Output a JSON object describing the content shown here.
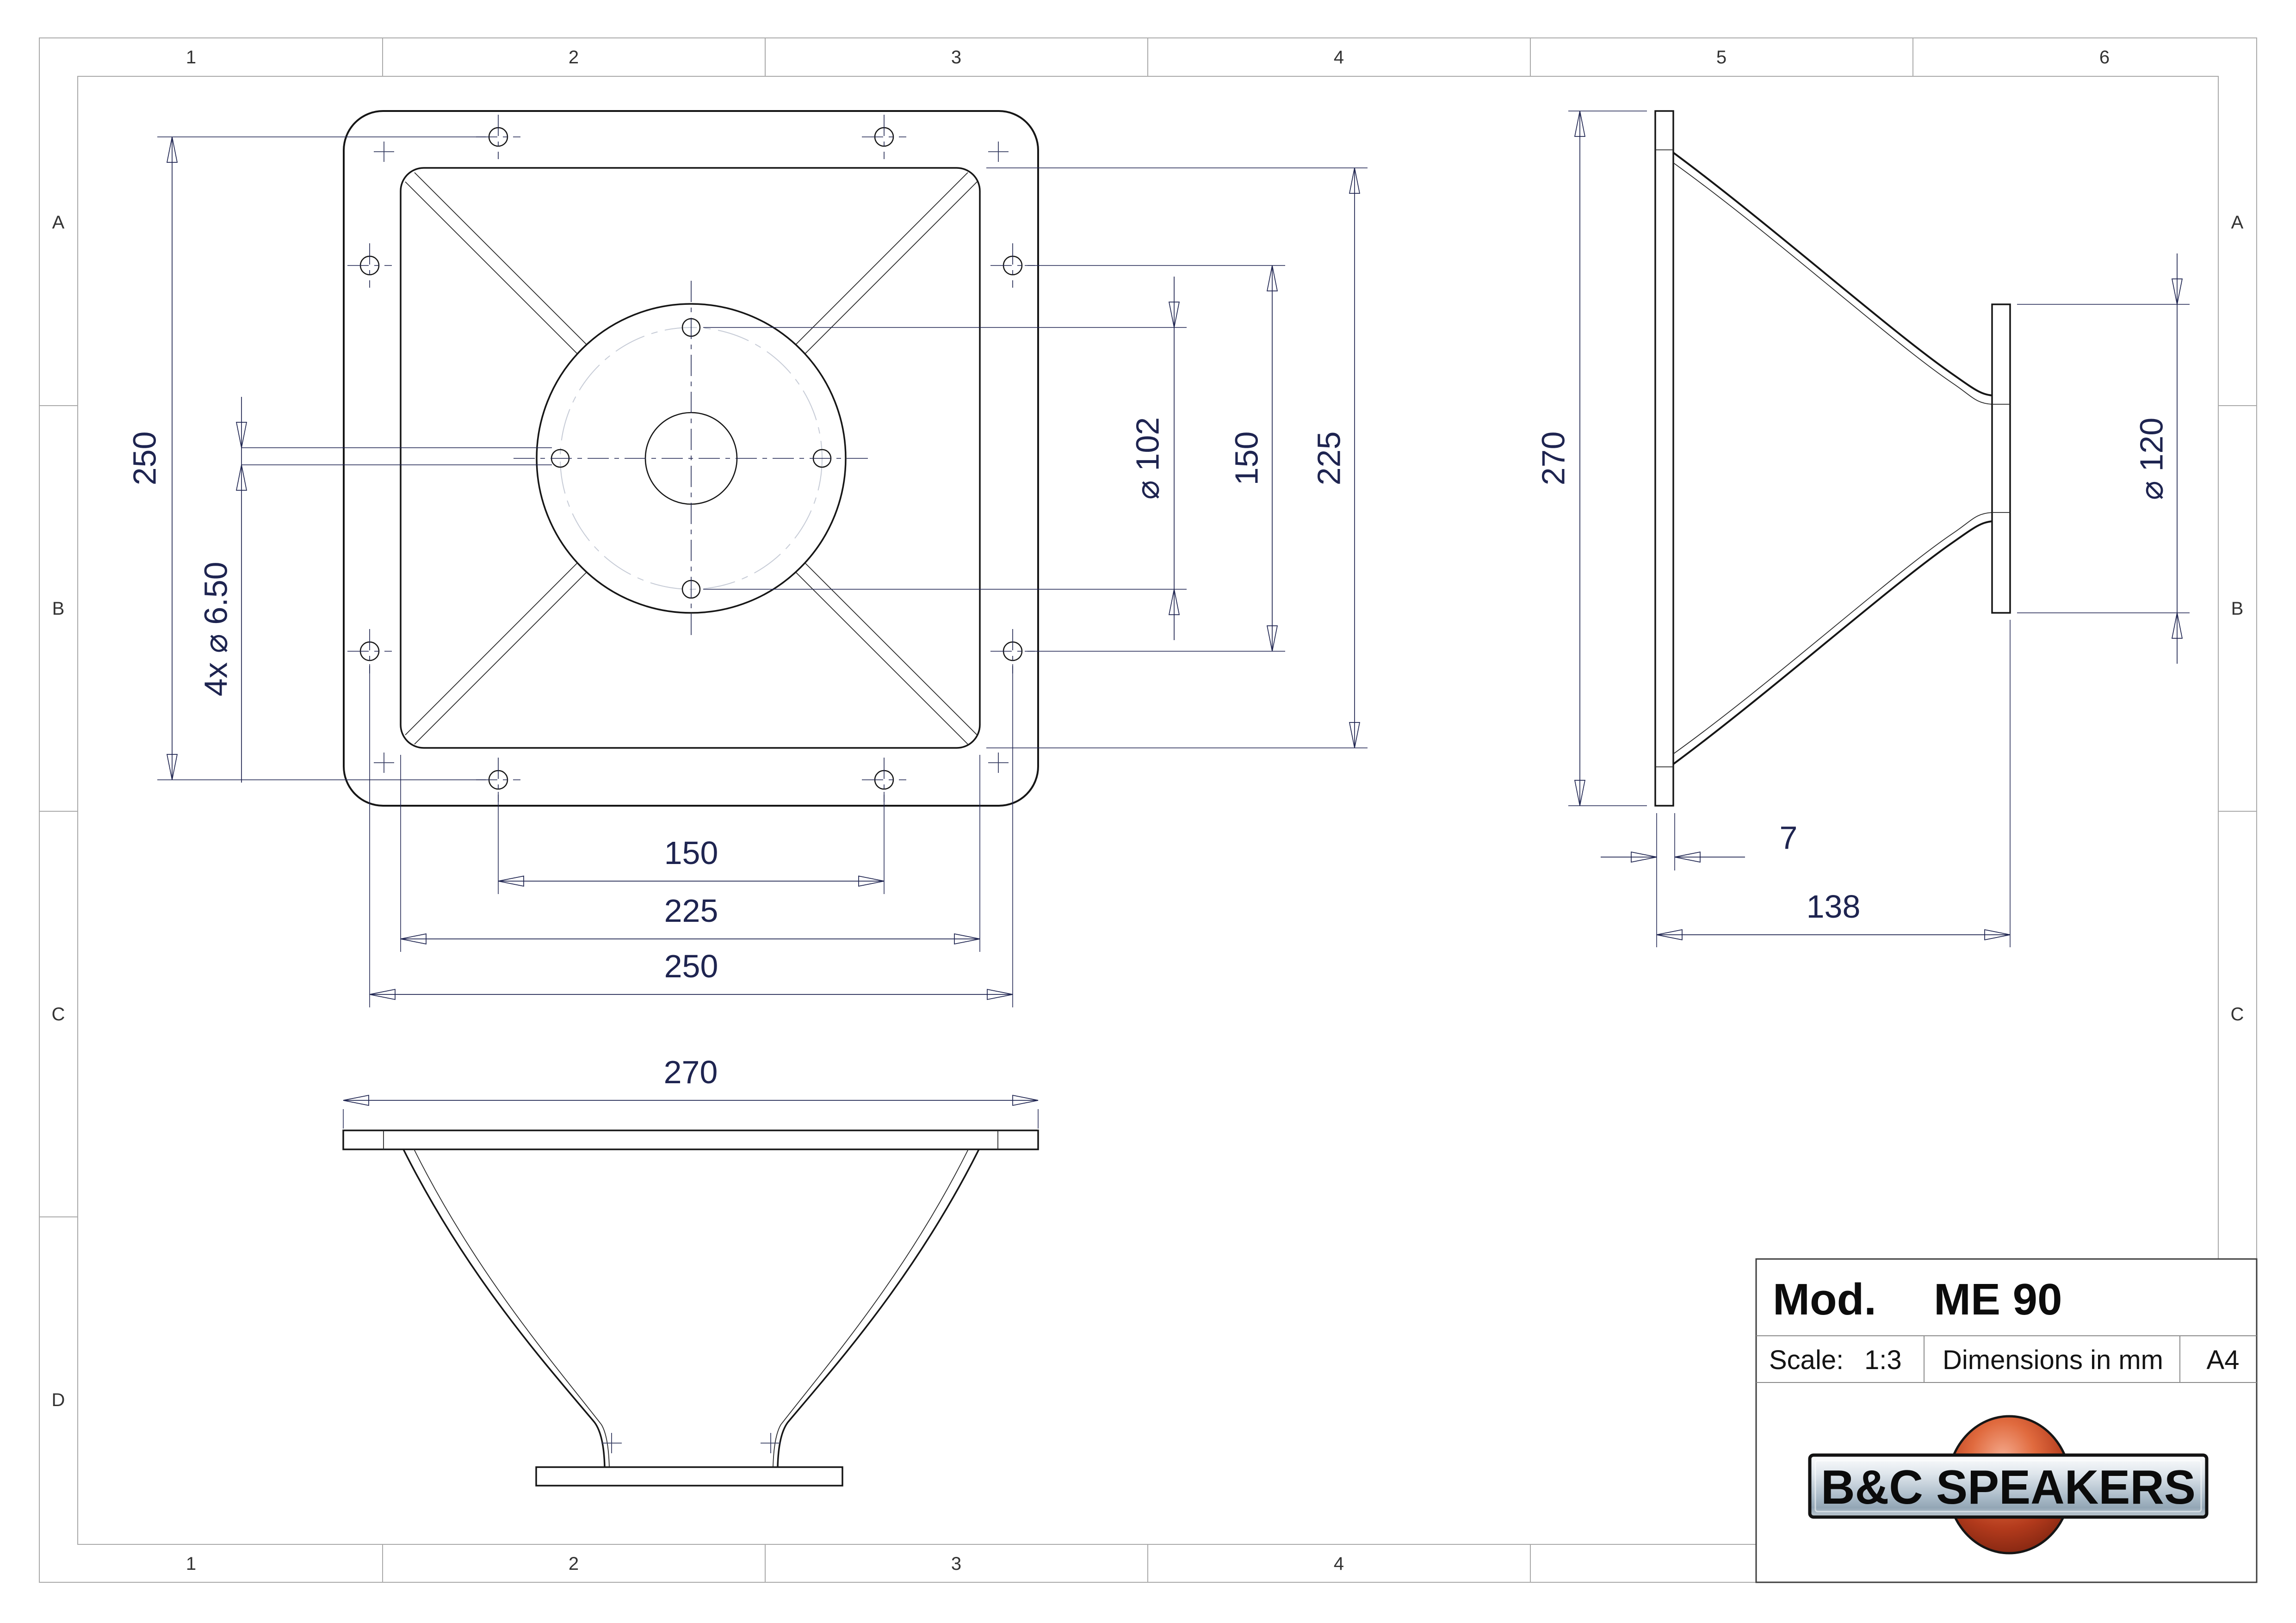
{
  "grid": {
    "top": [
      "1",
      "2",
      "3",
      "4",
      "5",
      "6"
    ],
    "bottom": [
      "1",
      "2",
      "3",
      "4"
    ],
    "left": [
      "A",
      "B",
      "C",
      "D"
    ],
    "right": [
      "A",
      "B",
      "C"
    ]
  },
  "front_view": {
    "dim_hole_rows": "250",
    "dim_hole_callout": "4x ⌀ 6.50",
    "dim_bolt_circle": "⌀ 102",
    "dim_side_holes": "150",
    "dim_inner_square": "225",
    "dim_bottom_hole_pair": "150",
    "dim_bottom_inner_square": "225",
    "dim_bottom_hole_cols": "250"
  },
  "side_view": {
    "dim_height": "270",
    "dim_throat_flange": "⌀ 120",
    "dim_flange_thickness": "7",
    "dim_depth": "138"
  },
  "bottom_view": {
    "dim_width": "270"
  },
  "title_block": {
    "model_label": "Mod.",
    "model": "ME 90",
    "scale_label": "Scale:",
    "scale": "1:3",
    "units_note": "Dimensions in mm",
    "sheet_size": "A4",
    "logo_text": "B&C SPEAKERS"
  },
  "colors": {
    "dimension_text": "#1e2450",
    "part_outline": "#161616",
    "frame_gray": "#a9a9a9",
    "logo_sphere_orange": "#b23a1c",
    "logo_bar_steel": "#aebecb"
  }
}
